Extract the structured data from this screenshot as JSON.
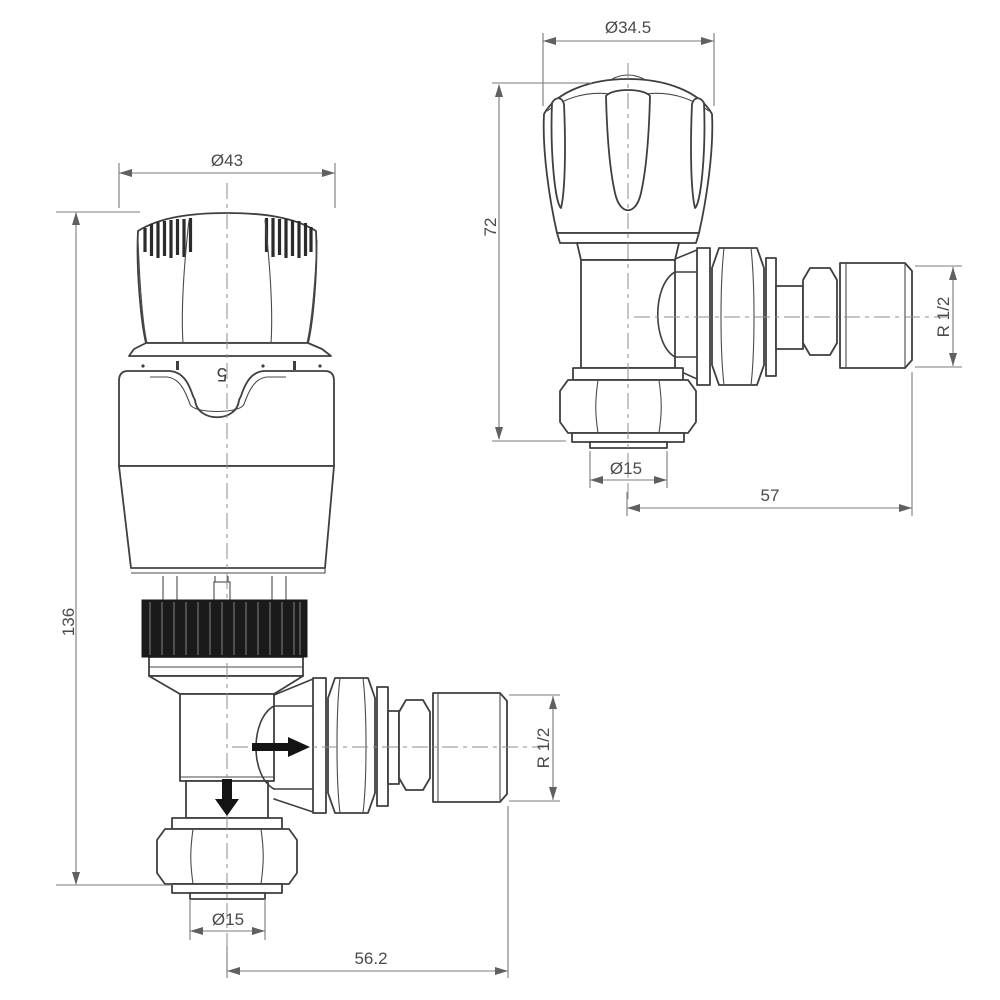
{
  "colors": {
    "background": "#ffffff",
    "outline": "#3f3f3f",
    "dimension_lines": "#7b7b7b",
    "dimension_text": "#4a4a4a",
    "knurl_fill": "#1a1a1a",
    "flow_arrow": "#141414"
  },
  "left_view": {
    "head_diameter": "Ø43",
    "overall_height": "136",
    "pipe_diameter": "Ø15",
    "centre_to_end": "56.2",
    "thread_size": "R 1/2",
    "setting_number": "5"
  },
  "right_view": {
    "head_diameter": "Ø34.5",
    "head_height": "72",
    "pipe_diameter": "Ø15",
    "centre_to_end": "57",
    "thread_size": "R 1/2"
  }
}
